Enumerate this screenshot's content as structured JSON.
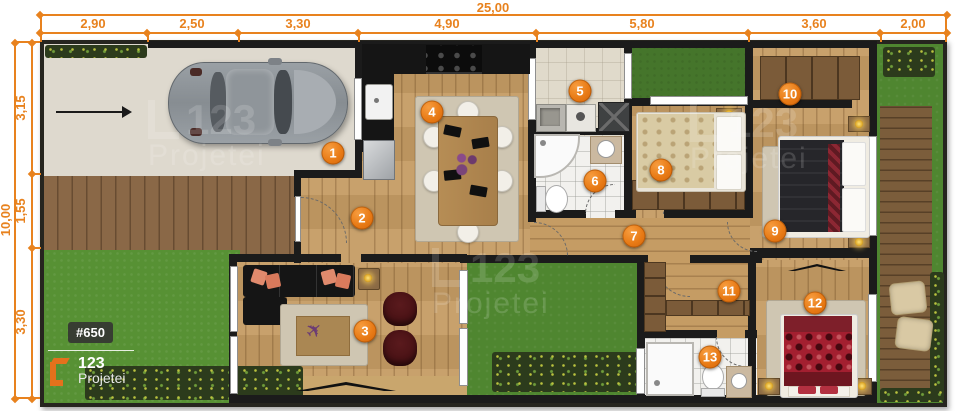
{
  "dimensions": {
    "top": {
      "total": "25,00",
      "segments": [
        "2,90",
        "2,50",
        "3,30",
        "4,90",
        "5,80",
        "3,60",
        "2,00"
      ]
    },
    "left": {
      "total": "10,00",
      "segments": [
        "3,15",
        "1,55",
        "3,30"
      ]
    }
  },
  "markers": [
    "1",
    "2",
    "3",
    "4",
    "5",
    "6",
    "7",
    "8",
    "9",
    "10",
    "11",
    "12",
    "13"
  ],
  "branding": {
    "badge": "#650",
    "logo_number": "123",
    "logo_name": "Projetei"
  },
  "watermark": {
    "number": "123",
    "name": "Projetei"
  },
  "icons": {
    "airplane": "✈"
  },
  "colors": {
    "dimension_orange": "#E8821E",
    "marker_orange": "#E8791D",
    "logo_orange": "#E4711C",
    "wall": "#1B1B1B",
    "grass": "#4F8630"
  }
}
